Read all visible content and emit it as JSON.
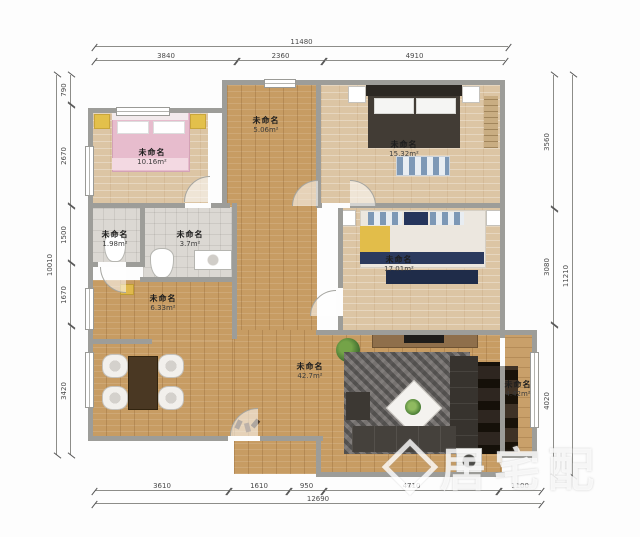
{
  "rooms": [
    {
      "name": "未命名",
      "area": "10.16m²"
    },
    {
      "name": "未命名",
      "area": "5.06m²"
    },
    {
      "name": "未命名",
      "area": "15.32m²"
    },
    {
      "name": "未命名",
      "area": "17.01m²"
    },
    {
      "name": "未命名",
      "area": "1.98m²"
    },
    {
      "name": "未命名",
      "area": "3.7m²"
    },
    {
      "name": "未命名",
      "area": "6.33m²"
    },
    {
      "name": "未命名",
      "area": "42.7m²"
    },
    {
      "name": "未命名",
      "area": "4.42m²"
    }
  ],
  "dims": {
    "top": {
      "total": "11480",
      "segments": [
        "3840",
        "2360",
        "4910"
      ]
    },
    "bottom": {
      "total": "12690",
      "segments": [
        "3610",
        "1610",
        "950",
        "4710",
        "1100"
      ]
    },
    "left": {
      "total": "10010",
      "segments": [
        "790",
        "2670",
        "1500",
        "1670",
        "3420"
      ]
    },
    "right": {
      "total": "11210",
      "segments": [
        "3560",
        "3080",
        "4020"
      ]
    }
  },
  "watermark": {
    "text": "居宅配"
  },
  "colors": {
    "wall": "#9d9d99",
    "wood_floor": "#c79c63",
    "bedroom_floor": "#dcc5a4",
    "tile": "#dbd8d3",
    "pink_bed": "#e7bccd",
    "dark_bed": "#423c35",
    "navy": "#2b3a5e",
    "accent_yellow": "#e3c04b"
  }
}
